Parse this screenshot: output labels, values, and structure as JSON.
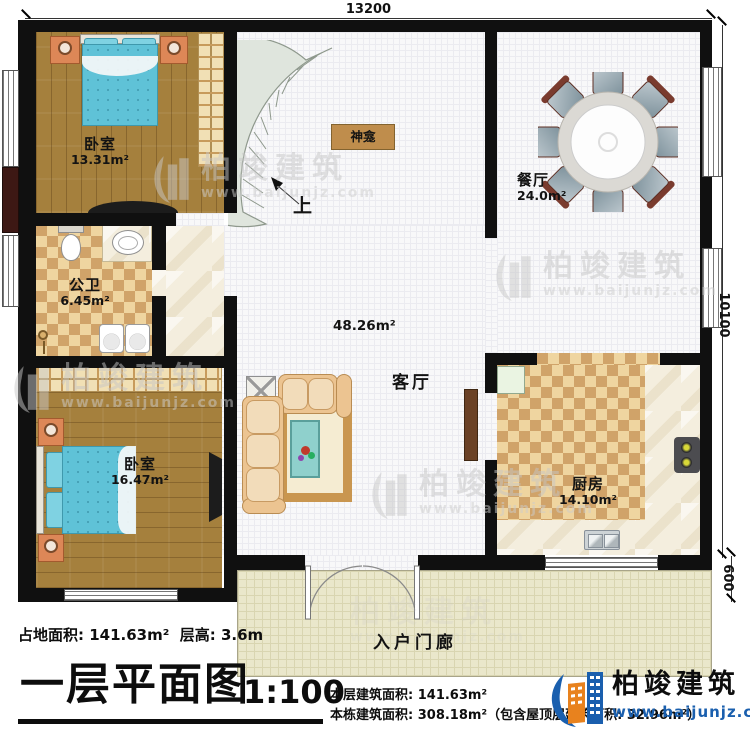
{
  "dimensions": {
    "width": "13200",
    "height": "10100",
    "porch": "600"
  },
  "rooms": {
    "bedroom1": {
      "name": "卧室",
      "area": "13.31m²"
    },
    "bathroom": {
      "name": "公卫",
      "area": "6.45m²"
    },
    "bedroom2": {
      "name": "卧室",
      "area": "16.47m²"
    },
    "dining": {
      "name": "餐厅",
      "area": "24.0m²"
    },
    "living": {
      "name": "客厅",
      "area": "48.26m²"
    },
    "kitchen": {
      "name": "厨房",
      "area": "14.10m²"
    },
    "shrine": {
      "name": "神龛"
    },
    "porch": {
      "name": "入户门廊"
    },
    "stairs_up": "上"
  },
  "footer": {
    "land_area": "占地面积: 141.63m²",
    "floor_height": "层高: 3.6m",
    "title": "一层平面图",
    "scale": "1:100",
    "this_floor_area": "本层建筑面积: 141.63m²",
    "building_area": "本栋建筑面积: 308.18m²（包含屋顶层建筑面积: 32.96m²）"
  },
  "logo": {
    "name": "柏竣建筑",
    "site": "www.baijunjz.com"
  },
  "watermark": {
    "name": "柏竣建筑",
    "site": "www.baijunjz.com"
  },
  "colors": {
    "wall": "#101010",
    "logo_blue": "#1a5fae",
    "logo_orange": "#e8821e",
    "wood_floor": "#a5803d",
    "tile_light": "#efd5a0",
    "tile_dark": "#d0a369",
    "bed": "#5fc2d7",
    "sofa": "#ecc491",
    "stairs": "#dfe5dd",
    "shrine": "#bf8d4c"
  }
}
